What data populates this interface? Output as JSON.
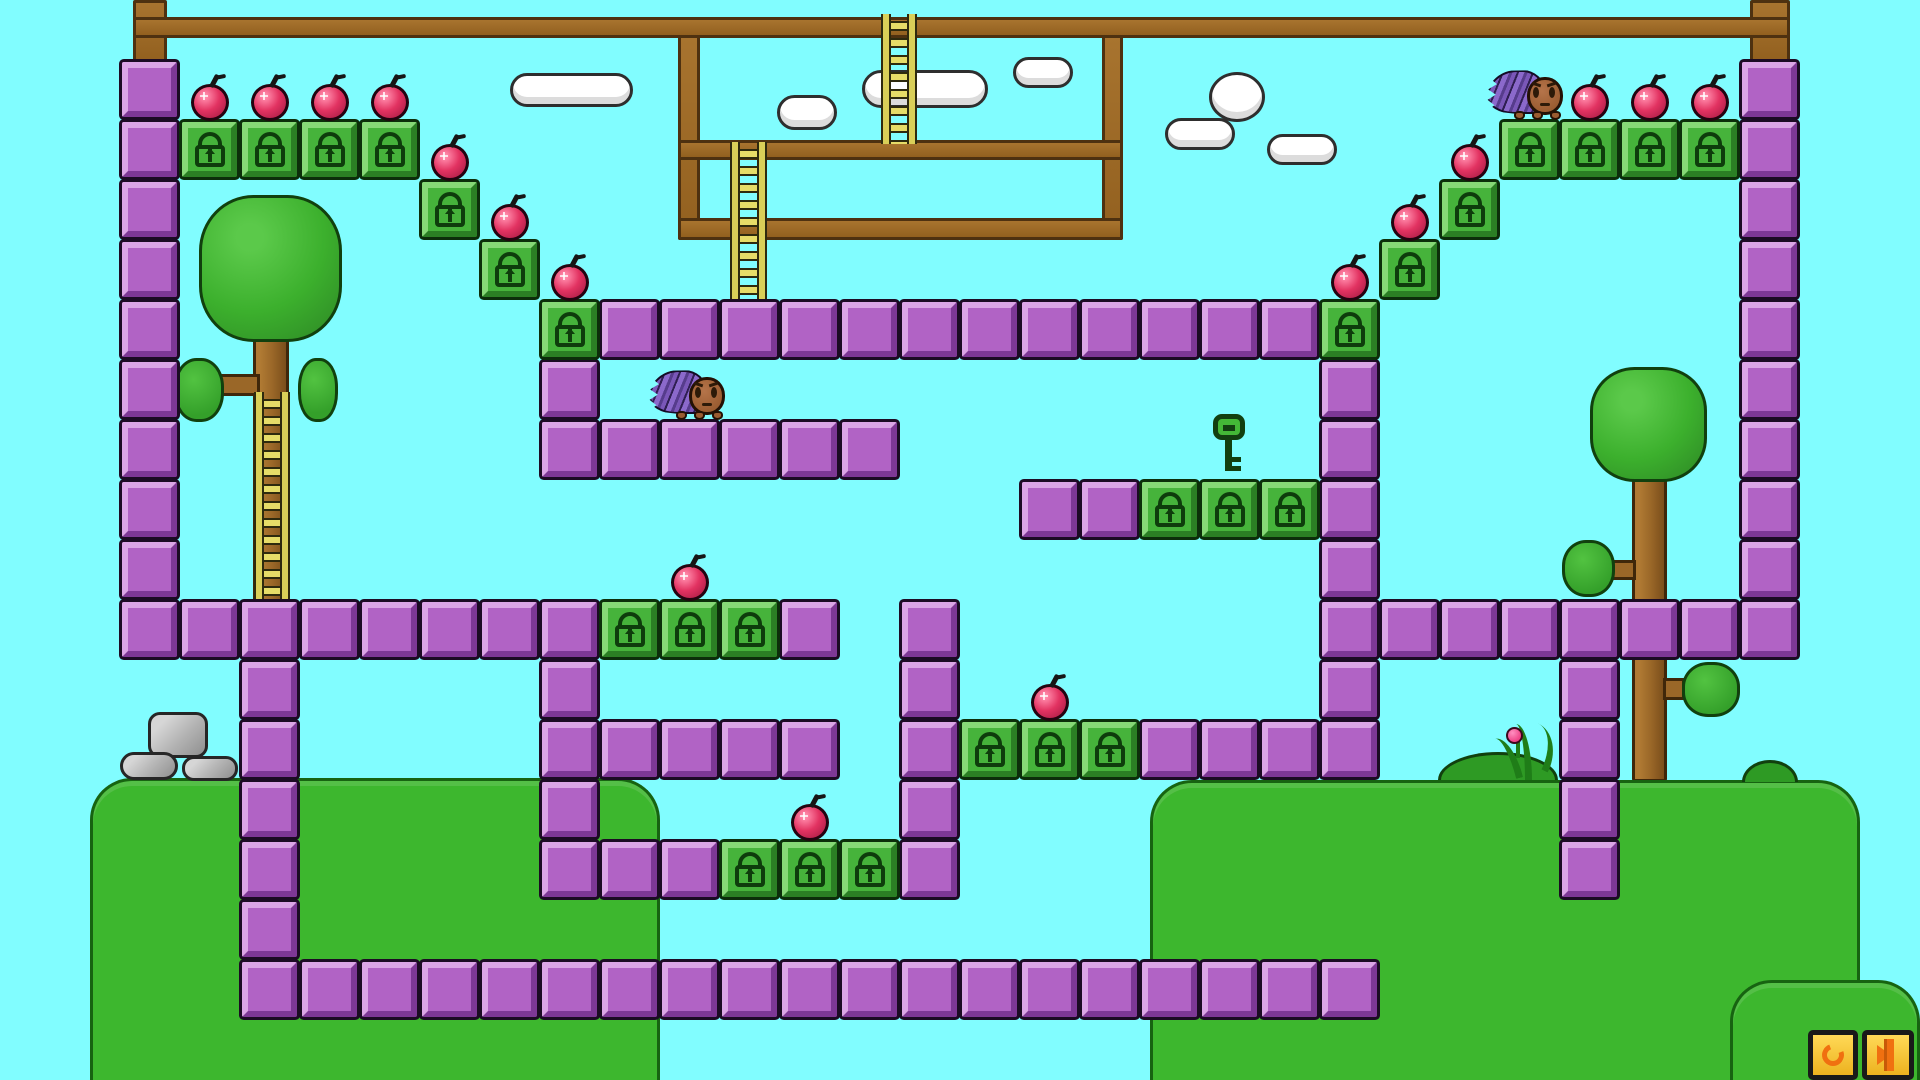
{
  "meta": {
    "app": "tile-platformer-level",
    "viewport": {
      "width": 1920,
      "height": 1080
    },
    "tile_size": 60,
    "grid": {
      "cols": 32,
      "rows": 18
    }
  },
  "palette": {
    "sky": "#81fdff",
    "purple_block": "#b163c5",
    "lock_block_green": "#46b33b",
    "lock_icon": "#0e3d0c",
    "wood": "#9a6728",
    "ladder": "#d9cf58",
    "grass": "#3db72e",
    "apple_red": "#e23261",
    "spike_purple": "#8b69cb",
    "body_brown": "#9a5c31",
    "stone_grey": "#b5b5b5",
    "button_yellow": "#f5c32b",
    "button_icon_orange": "#f07010"
  },
  "level": {
    "purple_blocks": [
      [
        2,
        1
      ],
      [
        2,
        2
      ],
      [
        2,
        3
      ],
      [
        2,
        4
      ],
      [
        2,
        5
      ],
      [
        2,
        6
      ],
      [
        2,
        7
      ],
      [
        2,
        8
      ],
      [
        2,
        9
      ],
      [
        2,
        10
      ],
      [
        3,
        10
      ],
      [
        4,
        10
      ],
      [
        5,
        10
      ],
      [
        6,
        10
      ],
      [
        7,
        10
      ],
      [
        8,
        10
      ],
      [
        9,
        10
      ],
      [
        13,
        10
      ],
      [
        10,
        5
      ],
      [
        11,
        5
      ],
      [
        12,
        5
      ],
      [
        13,
        5
      ],
      [
        14,
        5
      ],
      [
        15,
        5
      ],
      [
        16,
        5
      ],
      [
        17,
        5
      ],
      [
        18,
        5
      ],
      [
        19,
        5
      ],
      [
        20,
        5
      ],
      [
        21,
        5
      ],
      [
        9,
        6
      ],
      [
        9,
        7
      ],
      [
        10,
        7
      ],
      [
        11,
        7
      ],
      [
        12,
        7
      ],
      [
        13,
        7
      ],
      [
        14,
        7
      ],
      [
        17,
        8
      ],
      [
        18,
        8
      ],
      [
        22,
        6
      ],
      [
        22,
        7
      ],
      [
        22,
        8
      ],
      [
        22,
        9
      ],
      [
        22,
        10
      ],
      [
        22,
        11
      ],
      [
        22,
        12
      ],
      [
        9,
        11
      ],
      [
        9,
        12
      ],
      [
        10,
        12
      ],
      [
        11,
        12
      ],
      [
        12,
        12
      ],
      [
        13,
        12
      ],
      [
        19,
        12
      ],
      [
        20,
        12
      ],
      [
        21,
        12
      ],
      [
        9,
        13
      ],
      [
        9,
        14
      ],
      [
        10,
        14
      ],
      [
        11,
        14
      ],
      [
        15,
        14
      ],
      [
        15,
        10
      ],
      [
        15,
        11
      ],
      [
        15,
        12
      ],
      [
        15,
        13
      ],
      [
        4,
        11
      ],
      [
        4,
        12
      ],
      [
        4,
        13
      ],
      [
        4,
        14
      ],
      [
        4,
        15
      ],
      [
        4,
        16
      ],
      [
        5,
        16
      ],
      [
        6,
        16
      ],
      [
        7,
        16
      ],
      [
        8,
        16
      ],
      [
        9,
        16
      ],
      [
        10,
        16
      ],
      [
        11,
        16
      ],
      [
        12,
        16
      ],
      [
        13,
        16
      ],
      [
        14,
        16
      ],
      [
        15,
        16
      ],
      [
        16,
        16
      ],
      [
        17,
        16
      ],
      [
        18,
        16
      ],
      [
        19,
        16
      ],
      [
        20,
        16
      ],
      [
        21,
        16
      ],
      [
        22,
        16
      ],
      [
        23,
        10
      ],
      [
        24,
        10
      ],
      [
        25,
        10
      ],
      [
        26,
        10
      ],
      [
        27,
        10
      ],
      [
        28,
        10
      ],
      [
        29,
        1
      ],
      [
        29,
        2
      ],
      [
        29,
        3
      ],
      [
        29,
        4
      ],
      [
        29,
        5
      ],
      [
        29,
        6
      ],
      [
        29,
        7
      ],
      [
        29,
        8
      ],
      [
        29,
        9
      ],
      [
        29,
        10
      ],
      [
        26,
        11
      ],
      [
        26,
        12
      ],
      [
        26,
        13
      ],
      [
        26,
        14
      ]
    ],
    "lock_blocks": [
      [
        3,
        2
      ],
      [
        4,
        2
      ],
      [
        5,
        2
      ],
      [
        6,
        2
      ],
      [
        7,
        3
      ],
      [
        8,
        4
      ],
      [
        9,
        5
      ],
      [
        22,
        5
      ],
      [
        23,
        4
      ],
      [
        24,
        3
      ],
      [
        25,
        2
      ],
      [
        26,
        2
      ],
      [
        27,
        2
      ],
      [
        28,
        2
      ],
      [
        10,
        10
      ],
      [
        11,
        10
      ],
      [
        12,
        10
      ],
      [
        12,
        14
      ],
      [
        13,
        14
      ],
      [
        14,
        14
      ],
      [
        19,
        8
      ],
      [
        20,
        8
      ],
      [
        21,
        8
      ],
      [
        16,
        12
      ],
      [
        17,
        12
      ],
      [
        18,
        12
      ]
    ],
    "apples_on_blocks": [
      [
        3,
        2
      ],
      [
        4,
        2
      ],
      [
        5,
        2
      ],
      [
        6,
        2
      ],
      [
        7,
        3
      ],
      [
        8,
        4
      ],
      [
        9,
        5
      ],
      [
        22,
        5
      ],
      [
        23,
        4
      ],
      [
        24,
        3
      ],
      [
        26,
        2
      ],
      [
        27,
        2
      ],
      [
        28,
        2
      ],
      [
        11,
        10
      ],
      [
        13,
        14
      ],
      [
        17,
        12
      ]
    ],
    "apple_count": 16,
    "beams": [
      {
        "name": "top-beam",
        "x": 133,
        "y": 17,
        "w": 1657,
        "h": 21
      },
      {
        "name": "frame-beam-upper",
        "x": 678,
        "y": 140,
        "w": 445,
        "h": 20
      },
      {
        "name": "frame-beam-lower",
        "x": 678,
        "y": 218,
        "w": 445,
        "h": 22
      }
    ],
    "posts": [
      {
        "name": "left-post",
        "x": 133,
        "y": 0,
        "w": 34,
        "h": 64
      },
      {
        "name": "right-post",
        "x": 1750,
        "y": 0,
        "w": 40,
        "h": 64
      },
      {
        "name": "frame-post-left",
        "x": 678,
        "y": 33,
        "w": 22,
        "h": 207
      },
      {
        "name": "frame-post-right",
        "x": 1102,
        "y": 33,
        "w": 21,
        "h": 207
      }
    ],
    "ladders": [
      {
        "name": "ladder-top",
        "x": 883,
        "y": 14,
        "w": 32,
        "h": 130
      },
      {
        "name": "ladder-frame",
        "x": 732,
        "y": 142,
        "w": 33,
        "h": 160
      },
      {
        "name": "ladder-tree",
        "x": 256,
        "y": 392,
        "w": 32,
        "h": 210
      }
    ],
    "clouds": [
      {
        "x": 510,
        "y": 73,
        "w": 123,
        "h": 34,
        "shape": "pill"
      },
      {
        "x": 777,
        "y": 95,
        "w": 60,
        "h": 35,
        "shape": "pill"
      },
      {
        "x": 862,
        "y": 70,
        "w": 126,
        "h": 38,
        "shape": "pill"
      },
      {
        "x": 1013,
        "y": 57,
        "w": 60,
        "h": 31,
        "shape": "pill"
      },
      {
        "x": 1209,
        "y": 72,
        "w": 56,
        "h": 50,
        "shape": "egg"
      },
      {
        "x": 1165,
        "y": 118,
        "w": 70,
        "h": 32,
        "shape": "pill"
      },
      {
        "x": 1267,
        "y": 134,
        "w": 70,
        "h": 31,
        "shape": "pill"
      }
    ],
    "trees": [
      {
        "name": "tree-left",
        "trunk": {
          "x": 253,
          "y": 330,
          "w": 36,
          "h": 272
        },
        "foliage": {
          "x": 199,
          "y": 195,
          "w": 143,
          "h": 147
        },
        "bulbs": [
          {
            "x": 174,
            "y": 358,
            "w": 50,
            "h": 64
          },
          {
            "x": 298,
            "y": 358,
            "w": 40,
            "h": 64
          }
        ],
        "branches": [
          {
            "x": 218,
            "y": 374,
            "w": 42,
            "h": 22
          }
        ]
      },
      {
        "name": "tree-right",
        "trunk": {
          "x": 1632,
          "y": 470,
          "w": 35,
          "h": 312
        },
        "foliage": {
          "x": 1590,
          "y": 367,
          "w": 117,
          "h": 115
        },
        "bulbs": [
          {
            "x": 1562,
            "y": 540,
            "w": 53,
            "h": 57
          },
          {
            "x": 1682,
            "y": 662,
            "w": 58,
            "h": 55
          }
        ],
        "branches": [
          {
            "x": 1610,
            "y": 560,
            "w": 26,
            "h": 20
          },
          {
            "x": 1663,
            "y": 678,
            "w": 22,
            "h": 22
          }
        ]
      }
    ],
    "terrain": [
      {
        "name": "hill-bottom-left",
        "x": 90,
        "y": 778,
        "w": 570,
        "h": 302,
        "corner": "top"
      },
      {
        "name": "mound-bottom-right",
        "x": 1150,
        "y": 780,
        "w": 710,
        "h": 300,
        "corner": "top"
      },
      {
        "name": "hill-far-right-corner",
        "x": 1730,
        "y": 980,
        "w": 190,
        "h": 100,
        "corner": "top-left"
      }
    ],
    "grass_bump": {
      "x": 1742,
      "y": 760,
      "w": 56,
      "h": 22
    },
    "stones": [
      {
        "x": 148,
        "y": 712,
        "w": 60,
        "h": 46,
        "r": 12
      },
      {
        "x": 120,
        "y": 752,
        "w": 58,
        "h": 28,
        "r": 14
      },
      {
        "x": 182,
        "y": 756,
        "w": 56,
        "h": 25,
        "r": 12
      }
    ],
    "bush": {
      "bump": {
        "x": 1438,
        "y": 752,
        "w": 120,
        "h": 28
      },
      "blades": [
        {
          "x": 1500,
          "y": 736,
          "w": 18,
          "h": 44,
          "rot": -14
        },
        {
          "x": 1516,
          "y": 724,
          "w": 16,
          "h": 56,
          "rot": 0
        },
        {
          "x": 1528,
          "y": 728,
          "w": 30,
          "h": 40,
          "rot": 26
        }
      ],
      "flower": {
        "x": 1506,
        "y": 727,
        "w": 17,
        "h": 17
      },
      "stem": {
        "x": 1516,
        "y": 742,
        "w": 4,
        "h": 16
      }
    },
    "key": {
      "x": 1211,
      "y": 414,
      "w": 36,
      "h": 58
    },
    "characters": [
      {
        "name": "porcupine-player",
        "x": 1487,
        "y": 70,
        "w": 78,
        "h": 50,
        "standing_on": [
          25,
          2
        ],
        "facing": "right"
      },
      {
        "name": "porcupine-second",
        "x": 649,
        "y": 370,
        "w": 78,
        "h": 50,
        "standing_on": [
          11,
          7
        ],
        "facing": "right"
      }
    ]
  },
  "hud": {
    "buttons": [
      {
        "name": "restart-button",
        "icon": "circular-arrows",
        "x": 1808,
        "y": 1030,
        "w": 50,
        "h": 50
      },
      {
        "name": "exit-button",
        "icon": "arrow-into-door",
        "x": 1862,
        "y": 1030,
        "w": 52,
        "h": 50
      }
    ]
  }
}
